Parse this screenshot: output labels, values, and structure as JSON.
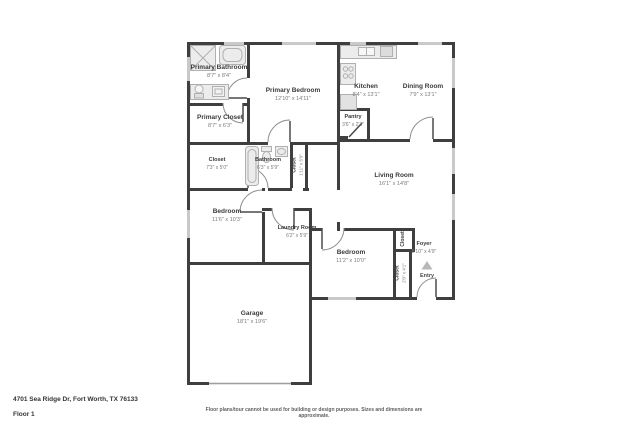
{
  "rooms": {
    "primary_bathroom": {
      "name": "Primary Bathroom",
      "dims": "8'7\" x 8'4\""
    },
    "primary_bedroom": {
      "name": "Primary Bedroom",
      "dims": "12'10\" x 14'11\""
    },
    "primary_closet": {
      "name": "Primary Closet",
      "dims": "8'7\" x 6'3\""
    },
    "kitchen": {
      "name": "Kitchen",
      "dims": "8'4\" x 13'1\""
    },
    "dining_room": {
      "name": "Dining Room",
      "dims": "7'9\" x 13'1\""
    },
    "pantry": {
      "name": "Pantry",
      "dims": "3'6\" x 2'3\""
    },
    "closet_hall": {
      "name": "Closet",
      "dims": "7'3\" x 5'0\""
    },
    "bathroom": {
      "name": "Bathroom",
      "dims": "6'3\" x 5'9\""
    },
    "closet_bath": {
      "name": "Closet",
      "dims": "1'11\" x 5'9\""
    },
    "living_room": {
      "name": "Living Room",
      "dims": "16'1\" x 14'8\""
    },
    "bedroom_left": {
      "name": "Bedroom",
      "dims": "11'6\" x 10'3\""
    },
    "laundry_room": {
      "name": "Laundry Room",
      "dims": "6'2\" x 5'9\""
    },
    "bedroom_right": {
      "name": "Bedroom",
      "dims": "11'2\" x 10'0\""
    },
    "closet_foyer": {
      "name": "Closet",
      "dims": ""
    },
    "foyer": {
      "name": "Foyer",
      "dims": "5'10\" x 4'9\""
    },
    "closet_entry": {
      "name": "Closet",
      "dims": "2'0\" x 4'1\""
    },
    "garage": {
      "name": "Garage",
      "dims": "18'1\" x 19'6\""
    }
  },
  "entry": {
    "label": "Entry"
  },
  "footer": {
    "address": "4701 Sea Ridge Dr, Fort Worth, TX 76133",
    "floor": "Floor 1",
    "disclaimer": "Floor plans/tour cannot be used for building or design purposes. Sizes and dimensions are approximate."
  },
  "colors": {
    "wall": "#3f3f3f",
    "window": "#c9c9c9",
    "fixture_fill": "#ececec",
    "fixture_stroke": "#b0b0b0",
    "door_swing": "#8f8f8f"
  },
  "icons": {
    "entry_arrow": "entry-arrow-icon"
  }
}
